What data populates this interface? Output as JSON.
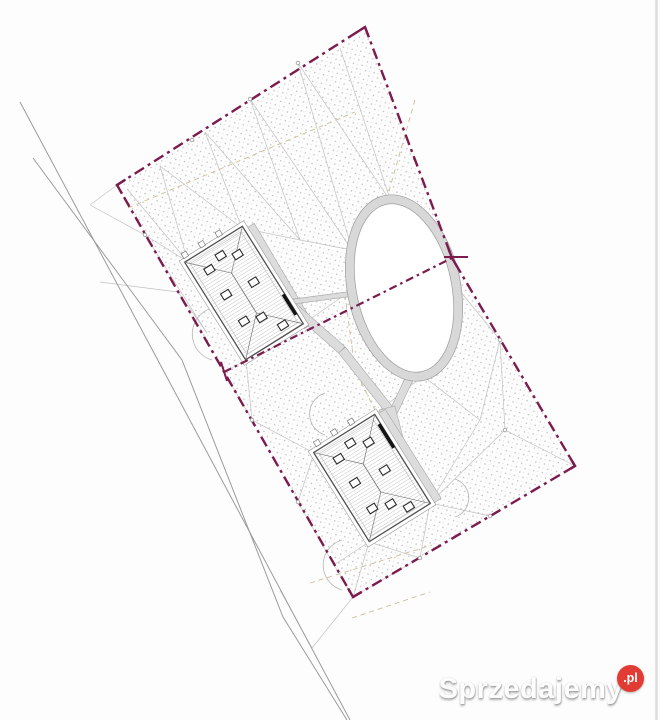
{
  "watermark": {
    "brand": "Sprzedajemy",
    "suffix": ".pl"
  },
  "palette": {
    "background": "#fdfdfd",
    "boundary": "#7b1b4e",
    "terrain_line": "#c2c2c2",
    "road_line": "#9b9b9b",
    "utility_dash": "#cdbd92",
    "driveway_fill": "#dcdcdc",
    "driveway_edge": "#a8a8a8",
    "building_outline": "#4f4f4f",
    "building_eave": "#999999",
    "roof_hatch": "#b3b3b3",
    "roof_ridge": "#7a7a7a",
    "window_outline": "#2b2b2b",
    "stipple_dot": "#bdbdbd",
    "stipple_dot2": "#d2d2d2",
    "ring_fill": "#d8d8d8",
    "ring_edge": "#9c9c9c",
    "arc_line": "#b5b5b5",
    "node_stroke": "#9a9a9a",
    "page_edge": "#dcdcdc",
    "watermark_badge": "#e23b33",
    "black_bar": "#151515"
  },
  "plan": {
    "size": [
      660,
      720
    ],
    "boundary": {
      "points": [
        [
          365,
          27
        ],
        [
          452,
          258
        ],
        [
          575,
          466
        ],
        [
          353,
          597
        ],
        [
          117,
          185
        ]
      ],
      "division": [
        [
          224,
          372
        ],
        [
          452,
          258
        ]
      ],
      "ticks": [
        [
          444,
          257,
          468,
          257
        ],
        [
          221,
          362,
          227,
          381
        ]
      ]
    },
    "roads": [
      [
        [
          20,
          102
        ],
        [
          350,
          720
        ]
      ],
      [
        [
          33,
          158
        ],
        [
          182,
          360
        ],
        [
          283,
          617
        ],
        [
          347,
          720
        ]
      ]
    ],
    "terrain_lines": [
      [
        128,
        190,
        188,
        262
      ],
      [
        160,
        166,
        188,
        262
      ],
      [
        160,
        166,
        242,
        228
      ],
      [
        205,
        132,
        242,
        228
      ],
      [
        205,
        132,
        300,
        240
      ],
      [
        250,
        99,
        300,
        240
      ],
      [
        250,
        99,
        352,
        250
      ],
      [
        298,
        63,
        352,
        250
      ],
      [
        298,
        63,
        391,
        202
      ],
      [
        340,
        48,
        391,
        202
      ],
      [
        391,
        202,
        452,
        258
      ],
      [
        242,
        228,
        300,
        240
      ],
      [
        300,
        240,
        352,
        250
      ],
      [
        145,
        235,
        188,
        262
      ],
      [
        145,
        235,
        207,
        333
      ],
      [
        178,
        292,
        207,
        333
      ],
      [
        224,
        372,
        246,
        360
      ],
      [
        224,
        372,
        252,
        420
      ],
      [
        252,
        420,
        246,
        360
      ],
      [
        252,
        420,
        314,
        453
      ],
      [
        298,
        502,
        314,
        453
      ],
      [
        298,
        502,
        334,
        565
      ],
      [
        334,
        565,
        369,
        542
      ],
      [
        353,
        597,
        334,
        565
      ],
      [
        353,
        597,
        369,
        542
      ],
      [
        353,
        597,
        420,
        558
      ],
      [
        420,
        558,
        369,
        542
      ],
      [
        420,
        558,
        430,
        503
      ],
      [
        490,
        516,
        430,
        503
      ],
      [
        575,
        466,
        505,
        430
      ],
      [
        505,
        430,
        430,
        503
      ],
      [
        505,
        430,
        500,
        340
      ],
      [
        500,
        340,
        455,
        285
      ],
      [
        500,
        340,
        480,
        420
      ],
      [
        480,
        420,
        423,
        376
      ],
      [
        480,
        420,
        430,
        503
      ],
      [
        423,
        376,
        375,
        414
      ],
      [
        352,
        290,
        303,
        324
      ],
      [
        90,
        205,
        145,
        235
      ],
      [
        100,
        282,
        178,
        292
      ],
      [
        353,
        597,
        312,
        648
      ],
      [
        280,
        590,
        312,
        648
      ],
      [
        117,
        185,
        90,
        205
      ]
    ],
    "utility_lines": [
      [
        [
          128,
          208
        ],
        [
          355,
          112
        ]
      ],
      [
        [
          415,
          100
        ],
        [
          385,
          205
        ],
        [
          345,
          295
        ],
        [
          355,
          370
        ],
        [
          385,
          430
        ],
        [
          402,
          470
        ]
      ],
      [
        [
          310,
          583
        ],
        [
          432,
          545
        ]
      ],
      [
        [
          352,
          618
        ],
        [
          430,
          592
        ]
      ]
    ],
    "arcs": [
      "M212 308 A27 27 0 0 0 212 360",
      "M325 393 A22 22 0 0 0 325 435",
      "M342 540 A26 26 0 0 0 342 590",
      "M455 479 A20 20 0 0 1 455 517"
    ],
    "driveways": [
      {
        "from": [
          250,
          226
        ],
        "to": [
          309,
          326
        ],
        "w": 10
      },
      {
        "from": [
          290,
          302
        ],
        "to": [
          358,
          293
        ],
        "w": 5
      },
      {
        "from": [
          292,
          306
        ],
        "to": [
          342,
          350
        ],
        "w": 9
      },
      {
        "from": [
          342,
          350
        ],
        "to": [
          391,
          412
        ],
        "w": 9
      },
      {
        "from": [
          420,
          356
        ],
        "to": [
          392,
          415
        ],
        "w": 8
      },
      {
        "from": [
          387,
          408
        ],
        "to": [
          397,
          446
        ],
        "w": 16
      },
      {
        "from": [
          381,
          412
        ],
        "to": [
          437,
          501
        ],
        "w": 10
      }
    ],
    "oval": {
      "cx": 404,
      "cy": 288,
      "rx": 52,
      "ry": 90,
      "rot": -12,
      "ring": 9
    },
    "buildings": [
      {
        "id": "upper",
        "cx": 244,
        "cy": 293,
        "w": 68,
        "h": 115,
        "rot": -32,
        "windows": [
          [
            -17,
            -38
          ],
          [
            0,
            -44
          ],
          [
            15,
            -36
          ],
          [
            -16,
            -8
          ],
          [
            14,
            -4
          ],
          [
            -15,
            24
          ],
          [
            2,
            30
          ],
          [
            16,
            48
          ]
        ],
        "bar": [
          22,
          46
        ],
        "stubs": [
          -30,
          -10,
          10
        ]
      },
      {
        "id": "lower",
        "cx": 372,
        "cy": 478,
        "w": 72,
        "h": 105,
        "rot": -32,
        "windows": [
          [
            -18,
            -34
          ],
          [
            0,
            -41
          ],
          [
            16,
            -32
          ],
          [
            -17,
            -5
          ],
          [
            15,
            0
          ],
          [
            -16,
            26
          ],
          [
            2,
            32
          ],
          [
            16,
            44
          ]
        ],
        "bar": [
          -42,
          -14
        ],
        "stubs": [
          -28,
          -8,
          12
        ]
      }
    ],
    "nodes": [
      [
        192,
        140
      ],
      [
        250,
        99
      ],
      [
        298,
        63
      ],
      [
        145,
        235
      ],
      [
        252,
        420
      ],
      [
        298,
        502
      ],
      [
        420,
        558
      ],
      [
        490,
        516
      ],
      [
        505,
        430
      ],
      [
        500,
        340
      ]
    ],
    "page_edge_x": 656.5
  }
}
